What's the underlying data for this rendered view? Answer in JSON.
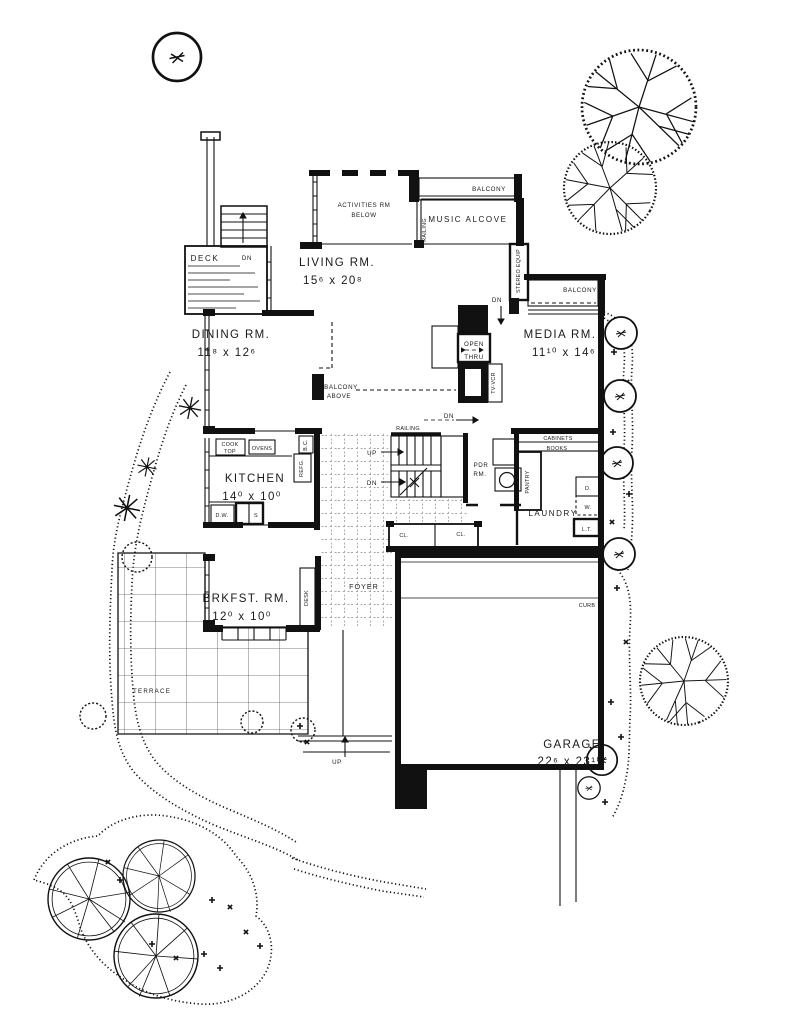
{
  "plan": {
    "rooms": {
      "activities": {
        "line1": "ACTIVITIES RM",
        "line2": "BELOW"
      },
      "living": {
        "name": "LIVING RM.",
        "dims": "15⁶ x 20⁸"
      },
      "dining": {
        "name": "DINING RM.",
        "dims": "11⁸ x 12⁶"
      },
      "media": {
        "name": "MEDIA RM.",
        "dims": "11¹⁰ x 14⁶"
      },
      "kitchen": {
        "name": "KITCHEN",
        "dims": "14⁰ x 10⁰"
      },
      "brkfst": {
        "name": "BRKFST. RM.",
        "dims": "12⁰ x 10⁰"
      },
      "garage": {
        "name": "GARAGE",
        "dims": "22⁶ x 23¹⁰"
      },
      "music_alcove": "MUSIC ALCOVE",
      "deck": "DECK",
      "foyer": "FOYER",
      "laundry": "LAUNDRY",
      "terrace": "TERRACE",
      "pdr": {
        "line1": "PDR",
        "line2": "RM."
      }
    },
    "fixtures": {
      "cook_top_1": "COOK",
      "cook_top_2": "TOP",
      "ovens": "OVENS",
      "refg": "REFG.",
      "bc": "B.C.",
      "dw": "D.W.",
      "sink": "S",
      "pantry": "PANTRY",
      "cabinets": "CABINETS",
      "books": "BOOKS",
      "dryer": "D.",
      "washer": "W.",
      "laundry_tub": "L.T.",
      "closet1": "CL.",
      "closet2": "CL.",
      "desk": "DESK",
      "stereo": "STEREO EQUIP",
      "tv_vcr": "TV-VCR",
      "open_thru_1": "OPEN",
      "open_thru_2": "THRU"
    },
    "annotations": {
      "balcony_top": "BALCONY",
      "balcony_media": "BALCONY",
      "balcony_above_1": "BALCONY",
      "balcony_above_2": "ABOVE",
      "railing_top": "RAILING",
      "railing_stairs": "RAILING",
      "curb": "CURB",
      "up_stairs": "UP",
      "dn_stairs": "DN",
      "up_walk": "UP",
      "dn_deck": "DN",
      "dn_media": "DN",
      "dn_hall": "DN"
    },
    "colors": {
      "ink": "#1a1a1a",
      "paper": "#ffffff"
    }
  }
}
